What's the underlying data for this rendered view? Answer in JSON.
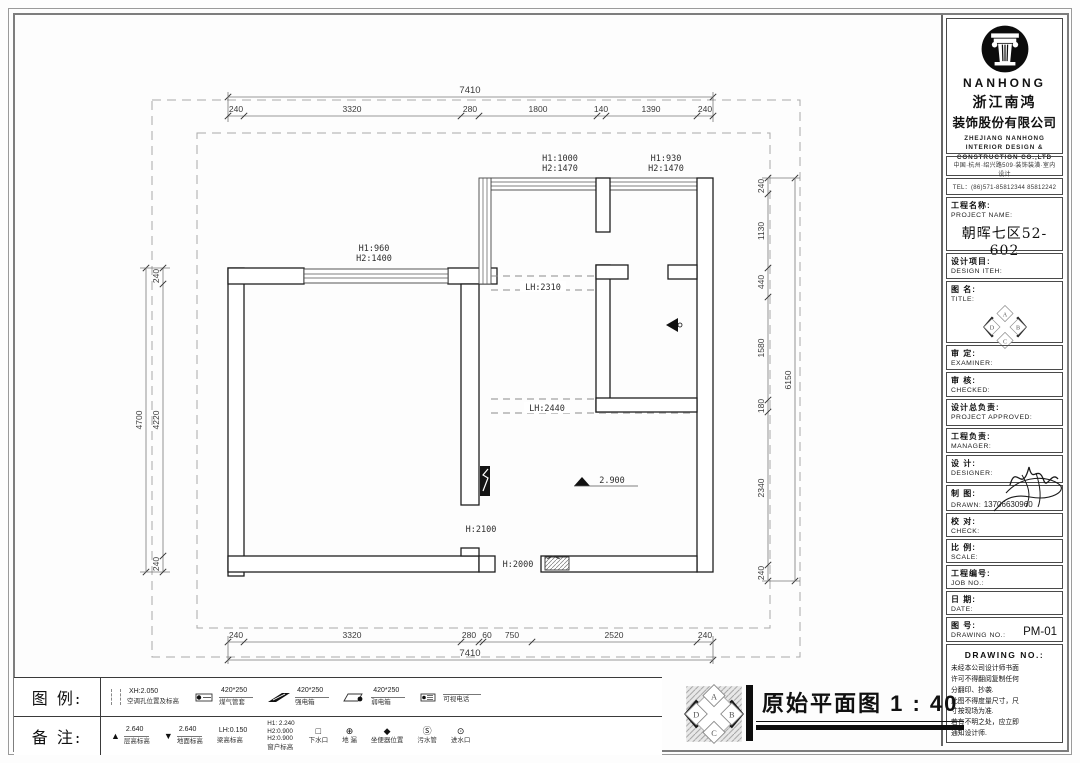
{
  "logo_abcd": [
    "A",
    "B",
    "C",
    "D"
  ],
  "company": {
    "logo": "NANHONG",
    "cn1": "浙江南鸿",
    "cn2": "装饰股份有限公司",
    "en1": "ZHEJIANG NANHONG",
    "en2": "INTERIOR DESIGN &",
    "en3": "CONSTRUCTION CO.,LTD",
    "address": "中国·杭州·绍兴路509·装饰装潢·室内设计",
    "tel": "TEL：(86)571-85812344  85812242"
  },
  "sidebar": {
    "rows": [
      {
        "cn": "工程名称:",
        "en": "PROJECT NAME:",
        "value": "朝晖七区52-602"
      },
      {
        "cn": "设计项目:",
        "en": "DESIGN ITEH:"
      },
      {
        "cn": "图  名:",
        "en": "TITLE:"
      },
      {
        "cn": "审  定:",
        "en": "EXAMINER:"
      },
      {
        "cn": "审  核:",
        "en": "CHECKED:"
      },
      {
        "cn": "设计总负责:",
        "en": "PROJECT APPROVED:"
      },
      {
        "cn": "工程负责:",
        "en": "MANAGER:"
      },
      {
        "cn": "设  计:",
        "en": "DESIGNER:"
      },
      {
        "cn": "制  图:",
        "en": "DRAWN:",
        "value": "13706630960"
      },
      {
        "cn": "校  对:",
        "en": "CHECK:"
      },
      {
        "cn": "比  例:",
        "en": "SCALE:"
      },
      {
        "cn": "工程编号:",
        "en": "JOB  NO.:"
      },
      {
        "cn": "日  期:",
        "en": "DATE:"
      },
      {
        "cn": "图  号:",
        "en": "DRAWING NO.:",
        "value": "PM-01"
      }
    ],
    "disclaimer": {
      "header": "DRAWING NO.:",
      "lines": [
        "未经本公司设计师书面",
        "许可不得翻阅复制任何",
        "分翻印、抄袭.",
        "此图不得度量尺寸，尺",
        "寸按现场为准.",
        "若有不明之处，应立即",
        "通知设计师."
      ]
    }
  },
  "plan": {
    "dims": {
      "top_total": "7410",
      "top": [
        "240",
        "3320",
        "280",
        "1800",
        "140",
        "1390",
        "240"
      ],
      "bottom": [
        "240",
        "3320",
        "280",
        "60",
        "750",
        "2520",
        "240"
      ],
      "bottom_total": "7410",
      "left": [
        "240",
        "4220",
        "240"
      ],
      "left_total": "4700",
      "right": [
        "240",
        "1130",
        "440",
        "1580",
        "180",
        "2340",
        "240"
      ],
      "right_total": "6150"
    },
    "labels": {
      "win_left_h1": "H1:960",
      "win_left_h2": "H2:1400",
      "win_mid_h1": "H1:1000",
      "win_mid_h2": "H2:1470",
      "win_right_h1": "H1:930",
      "win_right_h2": "H2:1470",
      "beam1": "LH:2310",
      "beam2": "LH:2440",
      "door1": "H:2100",
      "door2": "H:2000",
      "elevation": "2.900"
    }
  },
  "legend": {
    "row1_label": "图 例:",
    "row2_label": "备 注:",
    "items": [
      {
        "top": "XH:2.050",
        "name": "空调孔位置及标高"
      },
      {
        "top": "420*250",
        "name": "煤气管套"
      },
      {
        "top": "420*250",
        "name": "强电箱"
      },
      {
        "top": "420*250",
        "name": "弱电箱"
      },
      {
        "top": "",
        "name": "可视电话"
      }
    ],
    "notes": [
      {
        "sym": "▲",
        "top": "2.640",
        "name": "层高标高"
      },
      {
        "sym": "▼",
        "top": "2.640",
        "name": "地面标高"
      },
      {
        "top": "LH:0.150",
        "name": "梁高标高"
      },
      {
        "h1": "H1: 2.240",
        "h2": "H2:0.900",
        "h3": "H2:0.900",
        "name": "窗户标高"
      },
      {
        "sym": "□",
        "name": "下水口"
      },
      {
        "sym": "⊕",
        "name": "地 漏"
      },
      {
        "sym": "◆",
        "name": "坐便器位置"
      },
      {
        "sym": "Ⓢ",
        "name": "污水管"
      },
      {
        "sym": "⊙",
        "name": "进水口"
      }
    ]
  },
  "footer": {
    "title": "原始平面图 1 : 40"
  }
}
